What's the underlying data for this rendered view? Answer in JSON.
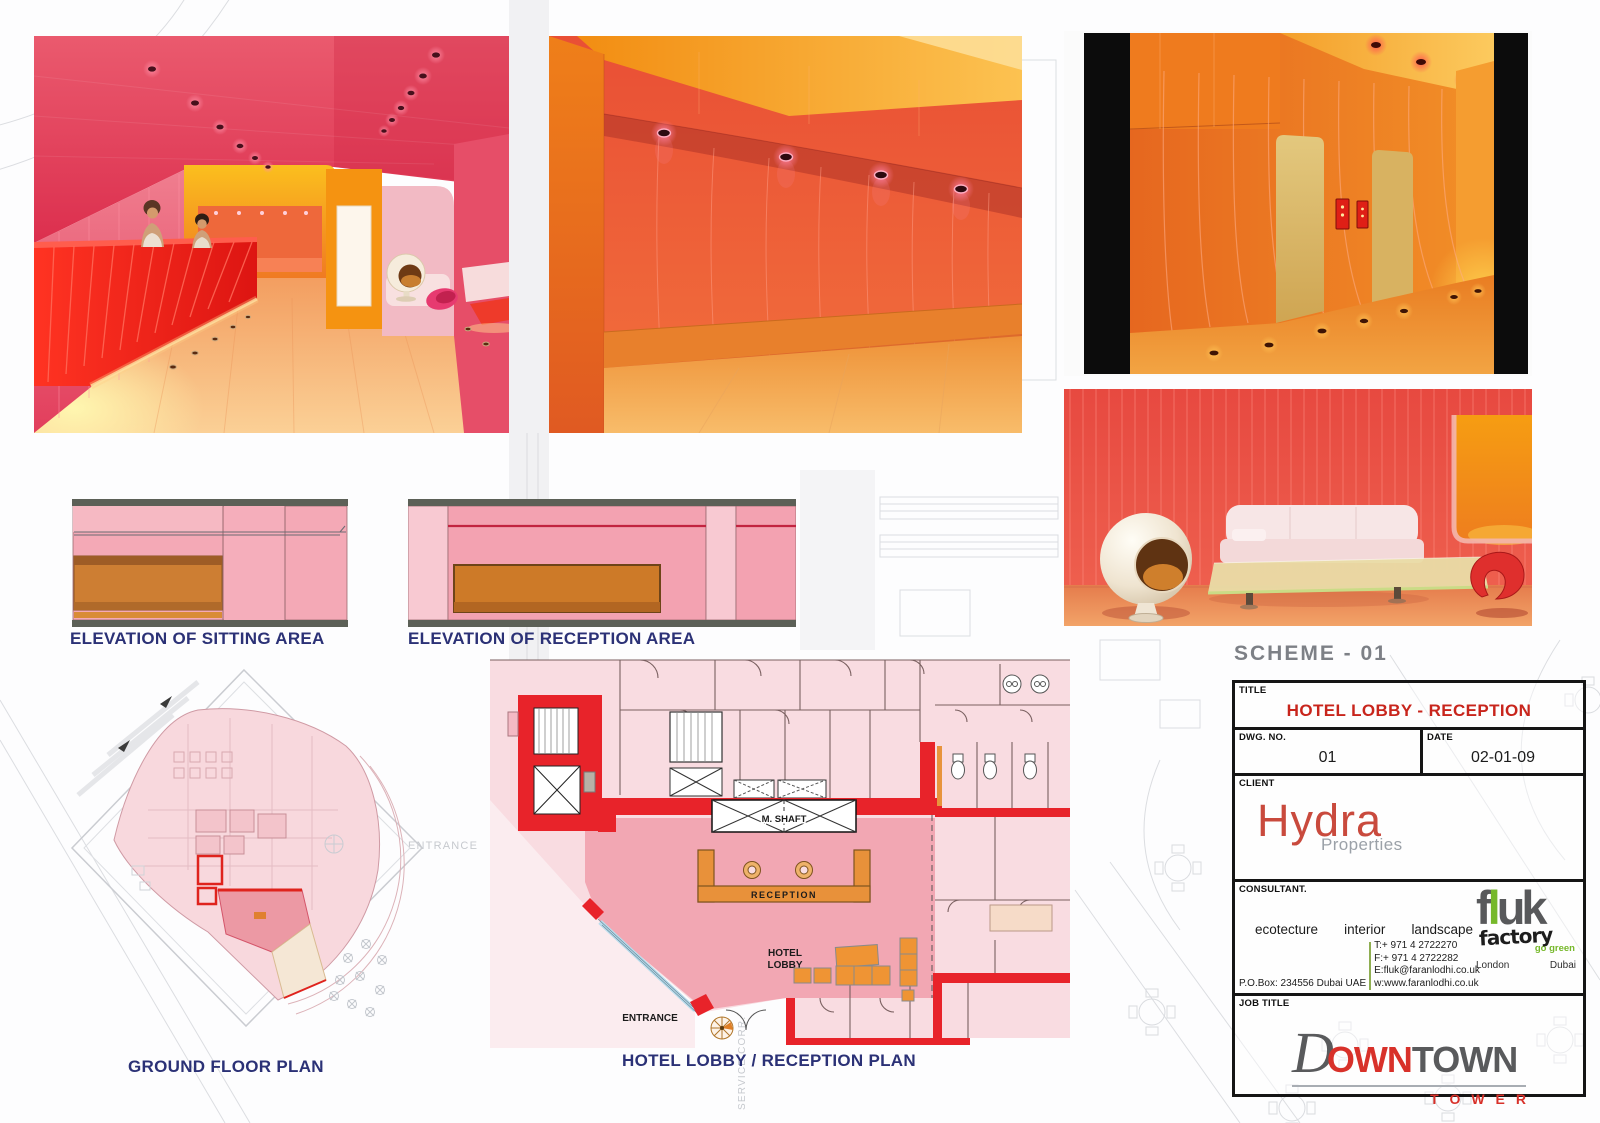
{
  "scheme": "SCHEME - 01",
  "captions": {
    "elevation_sitting": "ELEVATION OF SITTING AREA",
    "elevation_reception": "ELEVATION OF RECEPTION AREA",
    "ground_floor": "GROUND FLOOR PLAN",
    "lobby_plan": "HOTEL LOBBY / RECEPTION PLAN"
  },
  "plan": {
    "m_shaft": "M. SHAFT",
    "reception": "RECEPTION",
    "hotel": "HOTEL",
    "lobby": "LOBBY",
    "entrance": "ENTRANCE",
    "bg_entrance": "ENTRANCE",
    "bg_service": "SERVICE CORR."
  },
  "title_block": {
    "title_label": "TITLE",
    "title": "HOTEL LOBBY - RECEPTION",
    "dwg_label": "DWG. NO.",
    "dwg_no": "01",
    "date_label": "DATE",
    "date": "02-01-09",
    "client_label": "CLIENT",
    "client_name": "Hydra",
    "client_tagline": "Properties",
    "consultant_label": "CONSULTANT.",
    "disciplines": [
      "ecotecture",
      "interior",
      "landscape"
    ],
    "contact": {
      "pobox": "P.O.Box: 234556 Dubai UAE",
      "tel": "T:+ 971 4 2722270",
      "fax": "F:+ 971 4 2722282",
      "email": "E:fluk@faranlodhi.co.uk",
      "web": "w:www.faranlodhi.co.uk"
    },
    "fluk": {
      "f": "f",
      "l": "l",
      "uk": "uk",
      "factory": "factory",
      "tagline": "go green",
      "city1": "London",
      "city2": "Dubai"
    },
    "job_label": "JOB TITLE",
    "logo": {
      "d": "D",
      "own": "OWN",
      "town": "TOWN",
      "tower": "TOWER"
    }
  },
  "colors": {
    "accent_red": "#c8251c",
    "navy": "#2b3176",
    "wall_red": "#e8232a",
    "desk_orange": "#e8913a",
    "pink": "#f3a2b1",
    "green": "#76b82a"
  }
}
